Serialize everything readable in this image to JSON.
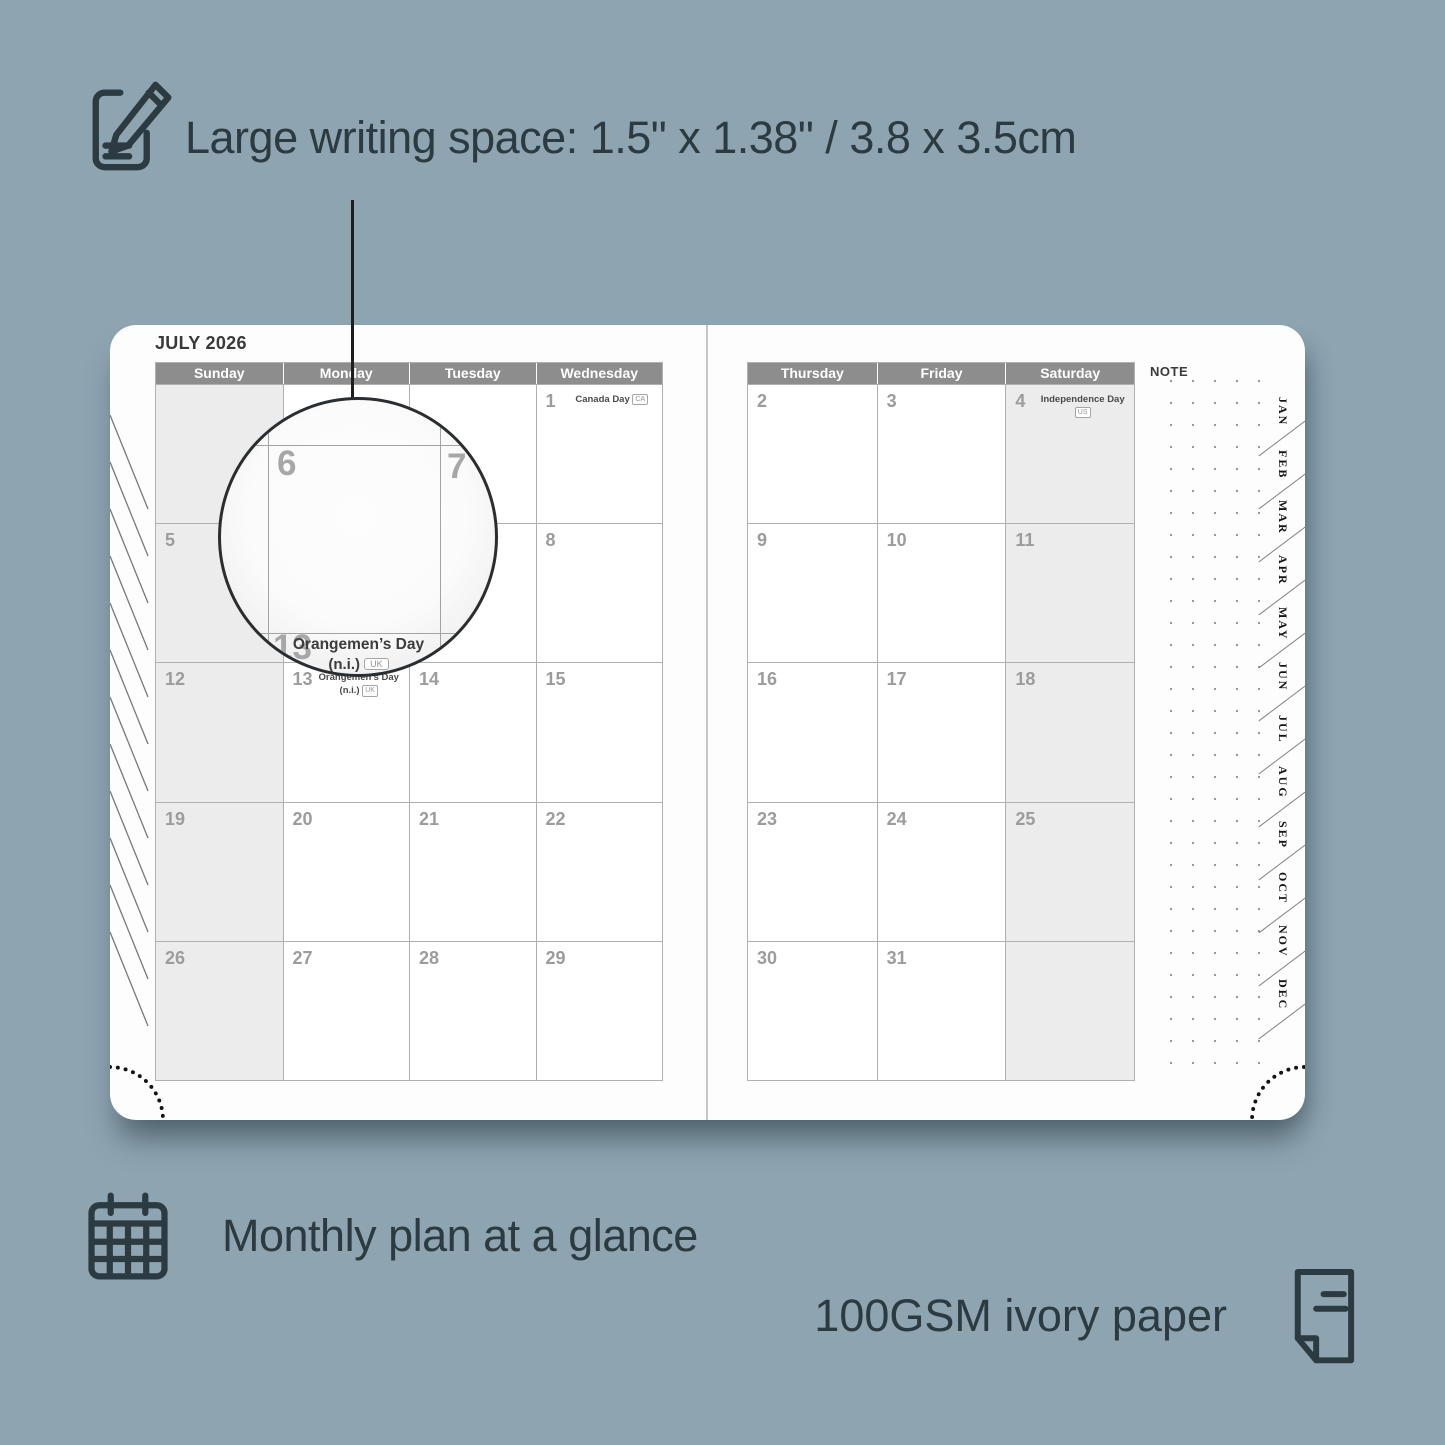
{
  "colors": {
    "background": "#8ea5b1",
    "accent_dark": "#2c3a41",
    "header_bg": "#8d8d8d",
    "shaded_cell": "#ececec"
  },
  "features": {
    "writing_space_label": "Large writing space: 1.5\" x 1.38\" / 3.8 x 3.5cm",
    "monthly_plan_label": "Monthly plan at a glance",
    "paper_label": "100GSM ivory paper"
  },
  "planner": {
    "month_title": "JULY 2026",
    "note_label": "NOTE",
    "left_day_headers": [
      "Sunday",
      "Monday",
      "Tuesday",
      "Wednesday"
    ],
    "right_day_headers": [
      "Thursday",
      "Friday",
      "Saturday"
    ],
    "month_tabs": [
      "JAN",
      "FEB",
      "MAR",
      "APR",
      "MAY",
      "JUN",
      "JUL",
      "AUG",
      "SEP",
      "OCT",
      "NOV",
      "DEC"
    ],
    "left_grid": [
      [
        {
          "day": "",
          "shaded": true
        },
        {
          "day": ""
        },
        {
          "day": ""
        },
        {
          "day": "1",
          "holiday": "Canada Day",
          "badge": "CA"
        }
      ],
      [
        {
          "day": "5",
          "shaded": true
        },
        {
          "day": "6"
        },
        {
          "day": "7"
        },
        {
          "day": "8"
        }
      ],
      [
        {
          "day": "12",
          "shaded": true
        },
        {
          "day": "13",
          "holiday": "Orangemen’s Day (n.i.)",
          "badge": "UK"
        },
        {
          "day": "14"
        },
        {
          "day": "15"
        }
      ],
      [
        {
          "day": "19",
          "shaded": true
        },
        {
          "day": "20"
        },
        {
          "day": "21"
        },
        {
          "day": "22"
        }
      ],
      [
        {
          "day": "26",
          "shaded": true
        },
        {
          "day": "27"
        },
        {
          "day": "28"
        },
        {
          "day": "29"
        }
      ]
    ],
    "right_grid": [
      [
        {
          "day": "2"
        },
        {
          "day": "3"
        },
        {
          "day": "4",
          "holiday": "Independence Day",
          "badge": "US",
          "shaded": true
        }
      ],
      [
        {
          "day": "9"
        },
        {
          "day": "10"
        },
        {
          "day": "11",
          "shaded": true
        }
      ],
      [
        {
          "day": "16"
        },
        {
          "day": "17"
        },
        {
          "day": "18",
          "shaded": true
        }
      ],
      [
        {
          "day": "23"
        },
        {
          "day": "24"
        },
        {
          "day": "25",
          "shaded": true
        }
      ],
      [
        {
          "day": "30"
        },
        {
          "day": "31"
        },
        {
          "day": "",
          "shaded": true
        }
      ]
    ]
  },
  "magnifier": {
    "day_main": "6",
    "day_right": "7",
    "day_bottom": "13",
    "holiday_line1": "Orangemen’s Day",
    "holiday_line2": "(n.i.)",
    "badge": "UK"
  }
}
